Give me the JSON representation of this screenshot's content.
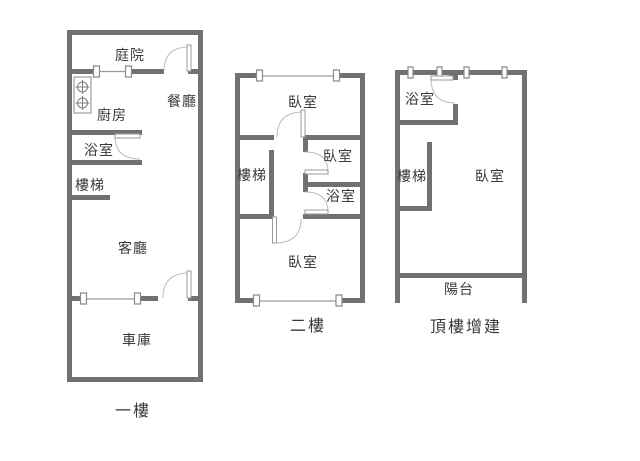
{
  "colors": {
    "background": "#ffffff",
    "wall": "#717171",
    "window_line": "#9a9a9a",
    "door_arc": "#bcbcbc",
    "text": "#3a3a3a"
  },
  "symbols": {
    "stove": "gas-stove-2-burner-icon",
    "door": "door-swing-arc",
    "window": "window-marker"
  },
  "floors": [
    {
      "id": "first-floor",
      "caption": "一樓",
      "rooms": [
        {
          "id": "courtyard",
          "label": "庭院"
        },
        {
          "id": "dining-room",
          "label": "餐廳"
        },
        {
          "id": "kitchen",
          "label": "廚房"
        },
        {
          "id": "bathroom",
          "label": "浴室"
        },
        {
          "id": "stairs",
          "label": "樓梯"
        },
        {
          "id": "living-room",
          "label": "客廳"
        },
        {
          "id": "garage",
          "label": "車庫"
        }
      ]
    },
    {
      "id": "second-floor",
      "caption": "二樓",
      "rooms": [
        {
          "id": "bedroom-top",
          "label": "臥室"
        },
        {
          "id": "stairs",
          "label": "樓梯"
        },
        {
          "id": "bedroom-middle",
          "label": "臥室"
        },
        {
          "id": "bathroom",
          "label": "浴室"
        },
        {
          "id": "bedroom-bottom",
          "label": "臥室"
        }
      ]
    },
    {
      "id": "rooftop-addition",
      "caption": "頂樓增建",
      "rooms": [
        {
          "id": "bathroom",
          "label": "浴室"
        },
        {
          "id": "stairs",
          "label": "樓梯"
        },
        {
          "id": "bedroom",
          "label": "臥室"
        },
        {
          "id": "balcony",
          "label": "陽台"
        }
      ]
    }
  ]
}
